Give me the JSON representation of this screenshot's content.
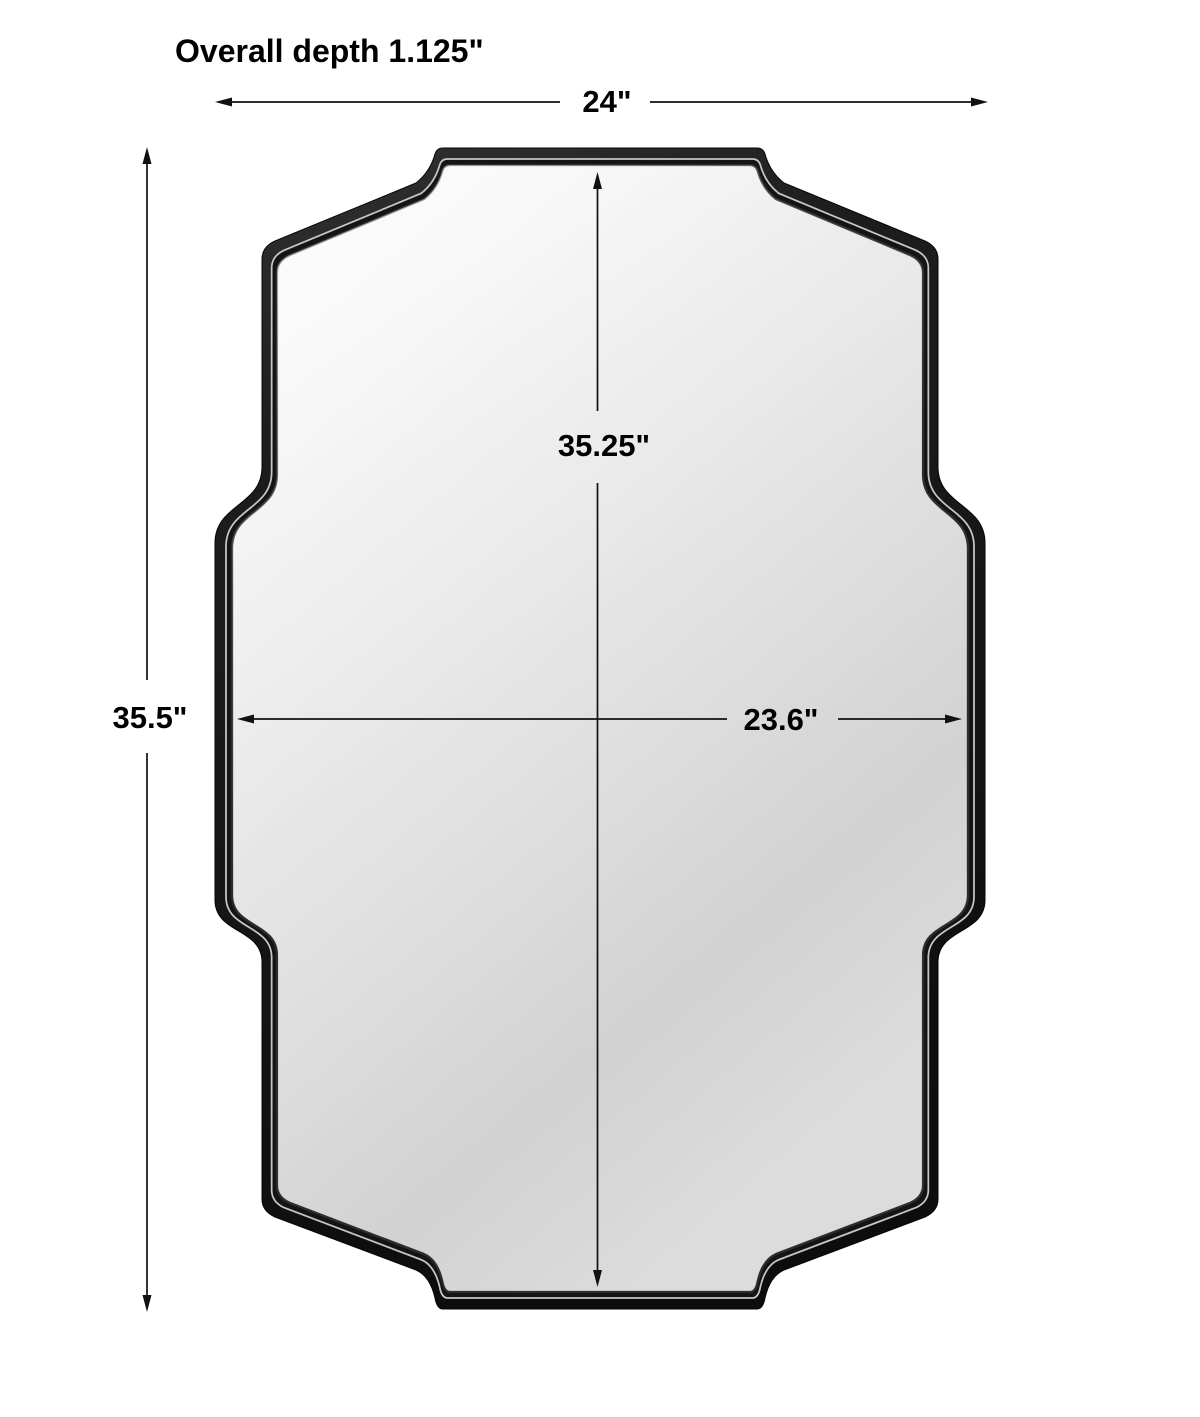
{
  "diagram": {
    "depth_note": "Overall depth 1.125\"",
    "labels": {
      "overall_width": "24\"",
      "overall_height": "35.5\"",
      "mirror_height": "35.25\"",
      "mirror_width": "23.6\""
    },
    "colors": {
      "background": "#ffffff",
      "frame_black": "#1a1a1a",
      "frame_highlight_line": "#c6c6c6",
      "glass_light": "#fafafa",
      "glass_dark": "#d2d2d2",
      "dimension_line": "#111111",
      "text": "#000000"
    }
  }
}
